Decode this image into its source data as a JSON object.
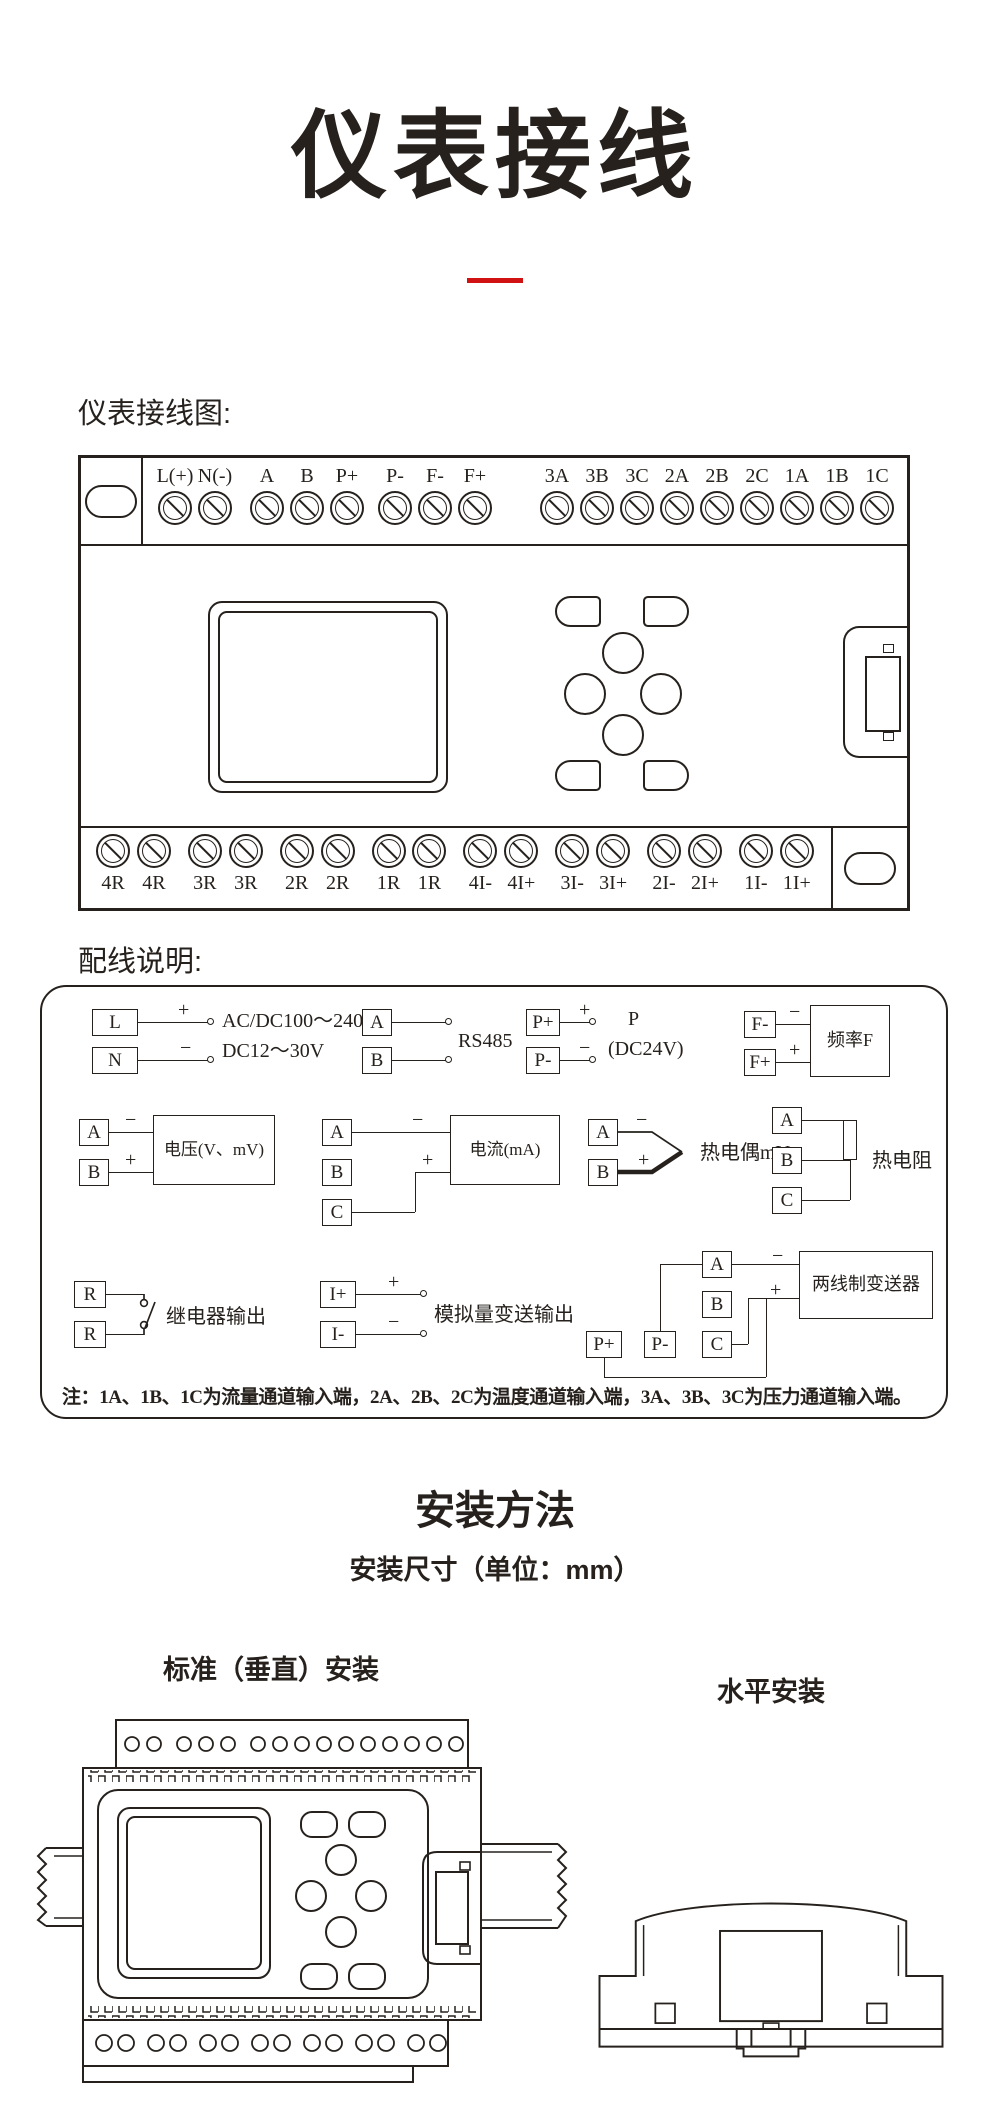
{
  "meta": {
    "accent_color": "#d01212",
    "line_color": "#26211d"
  },
  "title": "仪表接线",
  "wiring_figure": {
    "label": "仪表接线图:",
    "top_terminals": [
      "L(+)",
      "N(-)",
      "A",
      "B",
      "P+",
      "P-",
      "F-",
      "F+",
      "3A",
      "3B",
      "3C",
      "2A",
      "2B",
      "2C",
      "1A",
      "1B",
      "1C"
    ],
    "bottom_terminals": [
      "4R",
      "4R",
      "3R",
      "3R",
      "2R",
      "2R",
      "1R",
      "1R",
      "4I-",
      "4I+",
      "3I-",
      "3I+",
      "2I-",
      "2I+",
      "1I-",
      "1I+"
    ]
  },
  "wiring_notes": {
    "label": "配线说明:",
    "modules": {
      "power": {
        "t1": "L",
        "t2": "N",
        "plus": "+",
        "minus": "−",
        "line1": "AC/DC100～240V",
        "line2": "DC12～30V"
      },
      "rs485": {
        "t1": "A",
        "t2": "B",
        "label": "RS485"
      },
      "p24": {
        "t1": "P+",
        "t2": "P-",
        "plus": "+",
        "minus": "−",
        "line1": "P",
        "line2": "(DC24V)"
      },
      "freq": {
        "t1": "F-",
        "t2": "F+",
        "minus": "−",
        "plus": "+",
        "box": "频率F"
      },
      "voltage": {
        "t1": "A",
        "t2": "B",
        "minus": "−",
        "plus": "+",
        "box": "电压(V、mV)"
      },
      "current": {
        "t1": "A",
        "t2": "B",
        "t3": "C",
        "minus": "−",
        "plus": "+",
        "box": "电流(mA)"
      },
      "thermocouple": {
        "t1": "A",
        "t2": "B",
        "minus": "−",
        "plus": "+",
        "label": "热电偶mV"
      },
      "rtd": {
        "t1": "A",
        "t2": "B",
        "t3": "C",
        "label": "热电阻"
      },
      "relay": {
        "t1": "R",
        "t2": "R",
        "label": "继电器输出"
      },
      "analog": {
        "t1": "I+",
        "t2": "I-",
        "plus": "+",
        "minus": "−",
        "label": "模拟量变送输出"
      },
      "transmitter": {
        "t1": "A",
        "t2": "B",
        "t3": "C",
        "t4": "P+",
        "t5": "P-",
        "minus": "−",
        "plus": "+",
        "box": "两线制变送器"
      }
    },
    "note": "注：1A、1B、1C为流量通道输入端，2A、2B、2C为温度通道输入端，3A、3B、3C为压力通道输入端。"
  },
  "install": {
    "title": "安装方法",
    "subtitle": "安装尺寸（单位：mm）",
    "vertical_label": "标准（垂直）安装",
    "horizontal_label": "水平安装"
  }
}
